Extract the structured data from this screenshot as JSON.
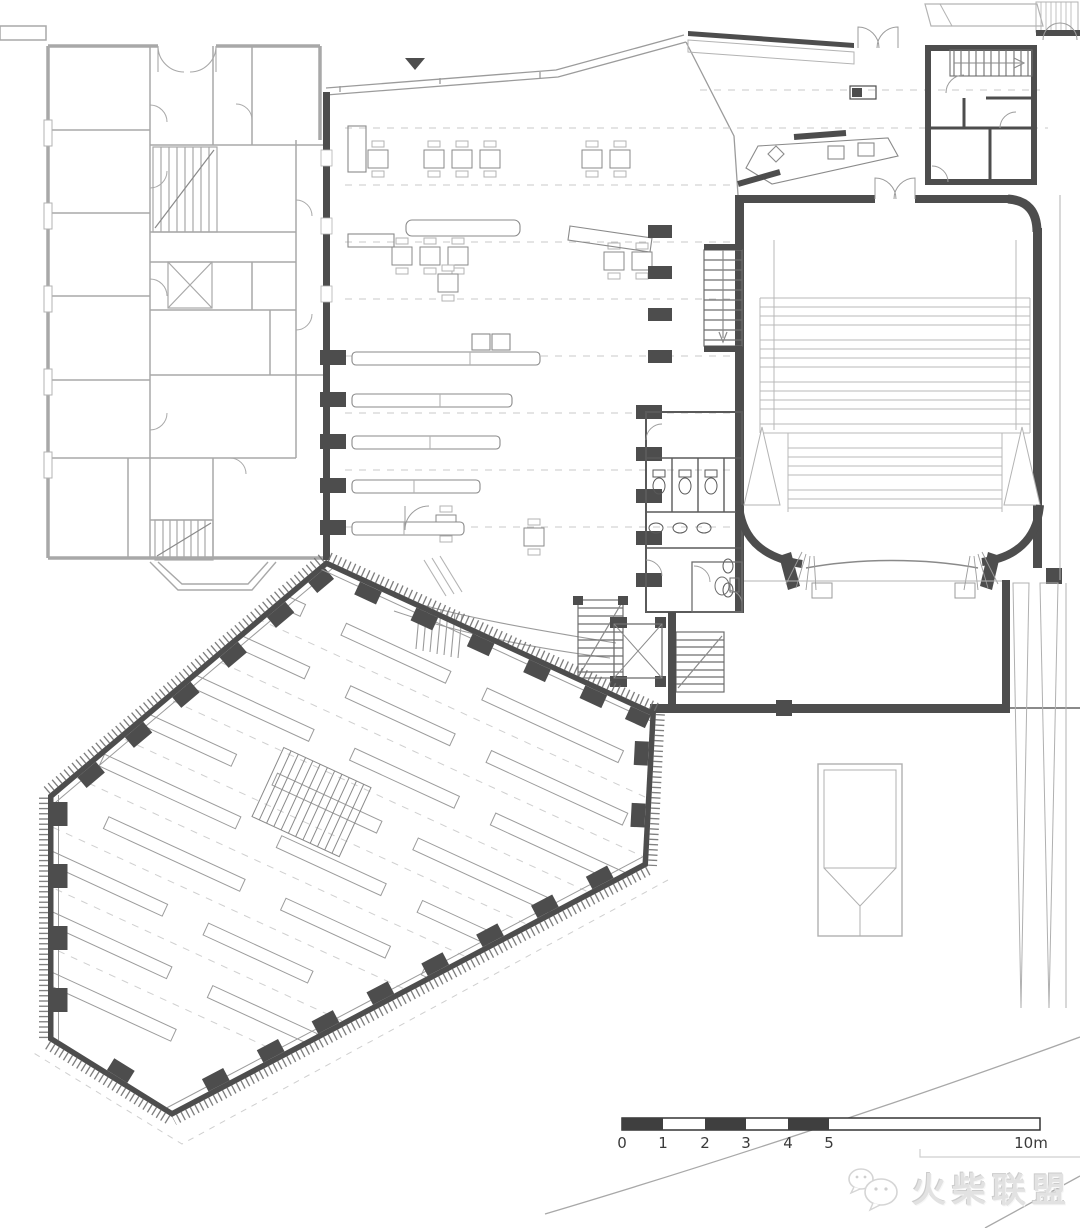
{
  "scale_bar": {
    "tick_labels": [
      "0",
      "1",
      "2",
      "3",
      "4",
      "5"
    ],
    "end_label": "10m",
    "filled_segments": "0-1, 2-3, 4-5",
    "fill_color": "#3f3f3f"
  },
  "watermark": {
    "text": "火柴联盟",
    "icon": "chat-bubbles-icon",
    "text_color": "#e2e2e2"
  },
  "colors": {
    "background": "#ffffff",
    "wall_dark": "#4d4d4d",
    "wall_medium": "#6e6e6e",
    "wall_light_existing": "#a8a8a8",
    "line_medium": "#8a8a8a",
    "line_light": "#b3b3b3",
    "dashed_line": "#c9c9c9",
    "hatch_tick": "#6f6f6f"
  }
}
